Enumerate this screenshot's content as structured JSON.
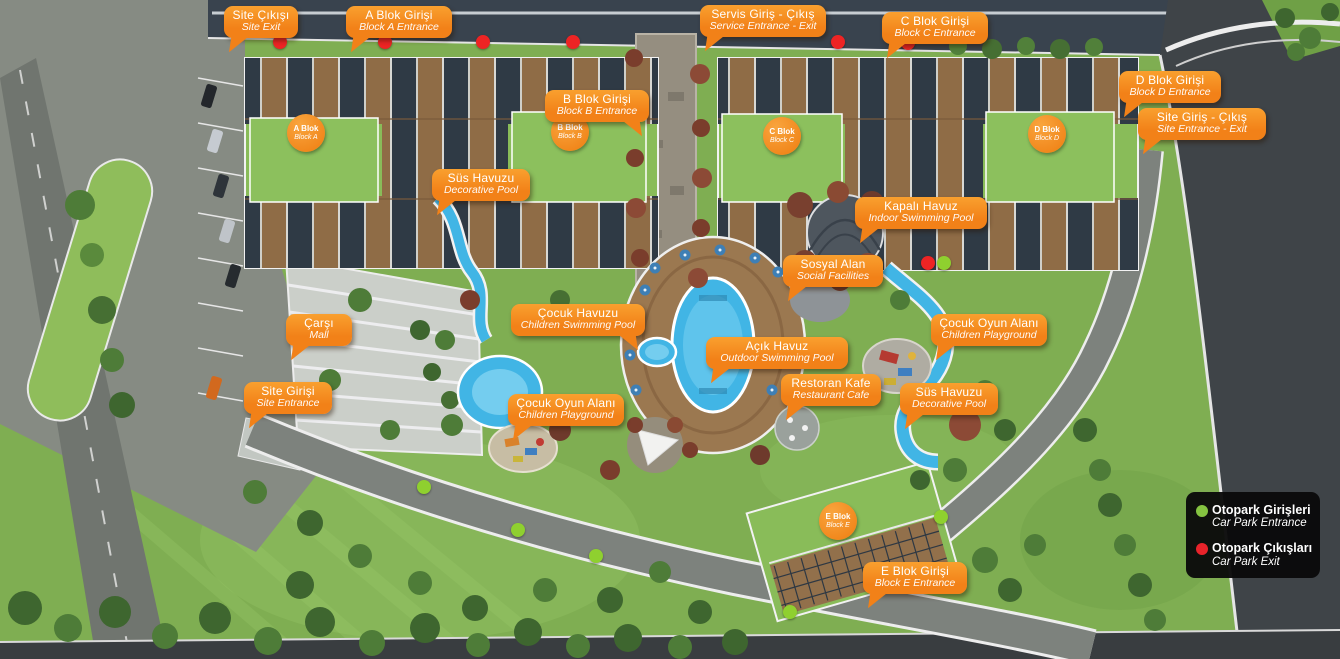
{
  "map": {
    "callouts": [
      {
        "id": "site-exit",
        "tr": "Site Çıkışı",
        "en": "Site Exit",
        "x": 224,
        "y": 6,
        "w": 74,
        "tail": "bl"
      },
      {
        "id": "block-a-entrance",
        "tr": "A Blok Girişi",
        "en": "Block A Entrance",
        "x": 346,
        "y": 6,
        "w": 106,
        "tail": "bl"
      },
      {
        "id": "service-entrance-exit",
        "tr": "Servis Giriş - Çıkış",
        "en": "Service Entrance - Exit",
        "x": 700,
        "y": 5,
        "w": 126,
        "tail": "bl"
      },
      {
        "id": "block-c-entrance",
        "tr": "C Blok Girişi",
        "en": "Block C Entrance",
        "x": 882,
        "y": 12,
        "w": 106,
        "tail": "bl"
      },
      {
        "id": "block-d-entrance",
        "tr": "D Blok Girişi",
        "en": "Block D Entrance",
        "x": 1119,
        "y": 71,
        "w": 102,
        "tail": "bl"
      },
      {
        "id": "site-entrance-exit",
        "tr": "Site Giriş - Çıkış",
        "en": "Site Entrance - Exit",
        "x": 1138,
        "y": 108,
        "w": 128,
        "tail": "bl"
      },
      {
        "id": "block-b-entrance",
        "tr": "B Blok Girişi",
        "en": "Block B Entrance",
        "x": 545,
        "y": 90,
        "w": 104,
        "tail": "br"
      },
      {
        "id": "decorative-pool-left",
        "tr": "Süs Havuzu",
        "en": "Decorative Pool",
        "x": 432,
        "y": 169,
        "w": 98,
        "tail": "bl"
      },
      {
        "id": "indoor-pool",
        "tr": "Kapalı Havuz",
        "en": "Indoor Swimming Pool",
        "x": 855,
        "y": 197,
        "w": 132,
        "tail": "bl"
      },
      {
        "id": "social-facilities",
        "tr": "Sosyal Alan",
        "en": "Social Facilities",
        "x": 783,
        "y": 255,
        "w": 100,
        "tail": "bl"
      },
      {
        "id": "children-pool",
        "tr": "Çocuk Havuzu",
        "en": "Children Swimming Pool",
        "x": 511,
        "y": 304,
        "w": 134,
        "tail": "br"
      },
      {
        "id": "outdoor-pool",
        "tr": "Açık Havuz",
        "en": "Outdoor Swimming Pool",
        "x": 706,
        "y": 337,
        "w": 142,
        "tail": "bl"
      },
      {
        "id": "mall",
        "tr": "Çarşı",
        "en": "Mall",
        "x": 286,
        "y": 314,
        "w": 66,
        "tail": "bl"
      },
      {
        "id": "playground-right",
        "tr": "Çocuk Oyun Alanı",
        "en": "Children Playground",
        "x": 931,
        "y": 314,
        "w": 116,
        "tail": "bl"
      },
      {
        "id": "restaurant-cafe",
        "tr": "Restoran Kafe",
        "en": "Restaurant Cafe",
        "x": 781,
        "y": 374,
        "w": 100,
        "tail": "bl"
      },
      {
        "id": "decorative-pool-right",
        "tr": "Süs Havuzu",
        "en": "Decorative Pool",
        "x": 900,
        "y": 383,
        "w": 98,
        "tail": "bl"
      },
      {
        "id": "site-entrance",
        "tr": "Site Girişi",
        "en": "Site Entrance",
        "x": 244,
        "y": 382,
        "w": 88,
        "tail": "bl"
      },
      {
        "id": "playground-left",
        "tr": "Çocuk Oyun Alanı",
        "en": "Children Playground",
        "x": 508,
        "y": 394,
        "w": 116,
        "tail": "bl"
      },
      {
        "id": "block-e-entrance",
        "tr": "E Blok Girişi",
        "en": "Block E Entrance",
        "x": 863,
        "y": 562,
        "w": 104,
        "tail": "bl"
      }
    ],
    "blocks": [
      {
        "id": "block-a",
        "tr": "A Blok",
        "en": "Block A",
        "cx": 306,
        "cy": 133
      },
      {
        "id": "block-b",
        "tr": "B Blok",
        "en": "Block B",
        "cx": 570,
        "cy": 132
      },
      {
        "id": "block-c",
        "tr": "C Blok",
        "en": "Block C",
        "cx": 782,
        "cy": 136
      },
      {
        "id": "block-d",
        "tr": "D Blok",
        "en": "Block D",
        "cx": 1047,
        "cy": 134
      },
      {
        "id": "block-e",
        "tr": "E Blok",
        "en": "Block E",
        "cx": 838,
        "cy": 521
      }
    ],
    "carpark_exits": [
      [
        280,
        42
      ],
      [
        385,
        42
      ],
      [
        483,
        42
      ],
      [
        573,
        42
      ],
      [
        838,
        42
      ],
      [
        908,
        43
      ],
      [
        928,
        263
      ]
    ],
    "carpark_entrances": [
      [
        944,
        263
      ],
      [
        424,
        487
      ],
      [
        518,
        530
      ],
      [
        596,
        556
      ],
      [
        941,
        517
      ],
      [
        790,
        612
      ]
    ]
  },
  "legend": {
    "items": [
      {
        "id": "carpark-entrance",
        "color": "#85C441",
        "tr": "Otopark Girişleri",
        "en": "Car Park Entrance"
      },
      {
        "id": "carpark-exit",
        "color": "#E8232A",
        "tr": "Otopark Çıkışları",
        "en": "Car Park Exit"
      }
    ]
  },
  "colors": {
    "callout": "#F28118",
    "badge": "#EE7D10",
    "exit_dot": "#ED2424",
    "entrance_dot": "#8FD02F",
    "pool": "#41B5E5"
  }
}
